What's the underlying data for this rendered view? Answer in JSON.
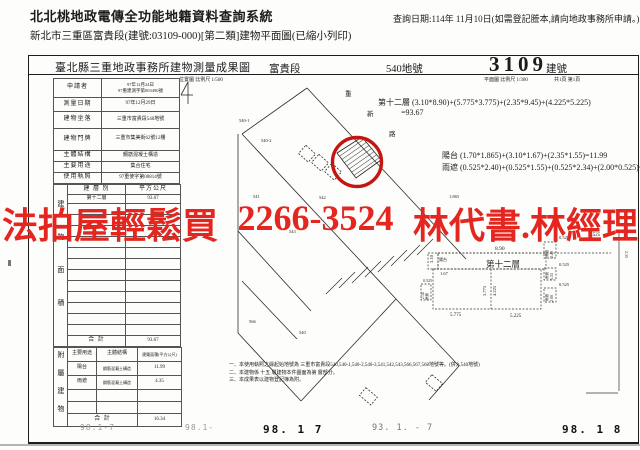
{
  "header": {
    "system_title": "北北桃地政電傳全功能地籍資料查詢系統",
    "query_date": "查詢日期:114年 11月10日(如需登記謄本,請向地政事務所申請。)",
    "subtitle": "新北市三重區富貴段(建號:03109-000)[第二類]建物平面圖(已縮小列印)"
  },
  "doc": {
    "title": "臺北縣三重地政事務所建物測量成果圖",
    "section": "富貴段",
    "land_no": "540地號",
    "building_no": "3109",
    "building_no_label": "建號",
    "scale_location": "位置圖 比例尺 1/500",
    "scale_plan": "平面圖 比例尺 1/300",
    "page_info": "共1頁 第1頁"
  },
  "info_table": {
    "rows": [
      {
        "label": "申請者",
        "value": "97年12月24日",
        "value2": "97重建測字第003490號"
      },
      {
        "label": "測量日期",
        "value": "97年12月29日"
      },
      {
        "label": "建物坐落",
        "value": "三重市富貴段540地號"
      },
      {
        "label": "建物門牌",
        "value": "三重市集美街62號12樓"
      },
      {
        "label": "主體結構",
        "value": "鋼筋混凝土構造"
      },
      {
        "label": "主要用途",
        "value": "集合住宅"
      },
      {
        "label": "使用執照",
        "value": "97重使字第00814號"
      }
    ]
  },
  "area_table": {
    "side_label": "建物面積",
    "col_floor": "建 層 別",
    "col_area": "平方公尺",
    "floor": "第十二層",
    "floor_area": "93.67",
    "total_label": "合 計",
    "total": "93.67"
  },
  "annex_table": {
    "side_label": "附屬建物",
    "col_use": "主要用途",
    "col_structure": "主體結構",
    "col_area": "建築面積(平方公尺)",
    "rows": [
      {
        "use": "陽台",
        "structure": "鋼筋混凝土構造",
        "area": "11.99"
      },
      {
        "use": "雨遮",
        "structure": "鋼筋混凝土構造",
        "area": "4.35"
      }
    ],
    "total_label": "合 計",
    "total": "16.34"
  },
  "formulas": {
    "floor": "第十二層 (3.10*8.90)+(5.775*3.775)+(2.35*9.45)+(4.225*5.225)",
    "floor_result": "=93.67",
    "balcony": "陽台 (1.70*1.865)+(3.10*1.67)+(2.35*1.55)=11.99",
    "canopy": "雨遮 (0.525*2.40)+(0.525*1.55)+(0.525*2.34)+(2.00*0.525)=4.35"
  },
  "notes": [
    "一、本使用執照之緣起始地號為 三重市富貴段540,540-1,540-2,540-3,541,542,543,566,567,568地號等。(併入540地號)",
    "二、本建物係 十五 層建物本件圖面為第 層部分。",
    "三、本成果表以建物登記簿為附。"
  ],
  "watermark": {
    "part1": "法拍屋輕鬆買",
    "part2": "2266-3524",
    "part3": "林代書.林經理",
    "color": "#e3261f"
  },
  "map": {
    "street_chars": [
      "重",
      "新",
      "路"
    ],
    "parcels": [
      "540-1",
      "540-2",
      "541",
      "542",
      "543",
      "566",
      "540"
    ]
  },
  "plan": {
    "title": "第十二層",
    "d890": "8.90",
    "d310": "3.10",
    "balcony": "陽台",
    "d167": "1.67",
    "d5775": "5.775",
    "d5225": "5.225",
    "d3775": "3.775",
    "d4225": "4.225",
    "d0525": "0.525",
    "yuzhe": "雨遮",
    "d240": "2.40",
    "d155": "1.55",
    "d200": "2.00",
    "d234": "2.34",
    "d1865": "1.865",
    "d235": "2.35"
  },
  "footer_stamps": [
    {
      "text": "98.1-7",
      "style": "faint"
    },
    {
      "text": "98.1-",
      "style": "faint"
    },
    {
      "text": "98. 1  7",
      "style": "bold"
    },
    {
      "text": "93. 1. - 7",
      "style": "faint2"
    },
    {
      "text": "98. 1  8",
      "style": "bold"
    }
  ]
}
